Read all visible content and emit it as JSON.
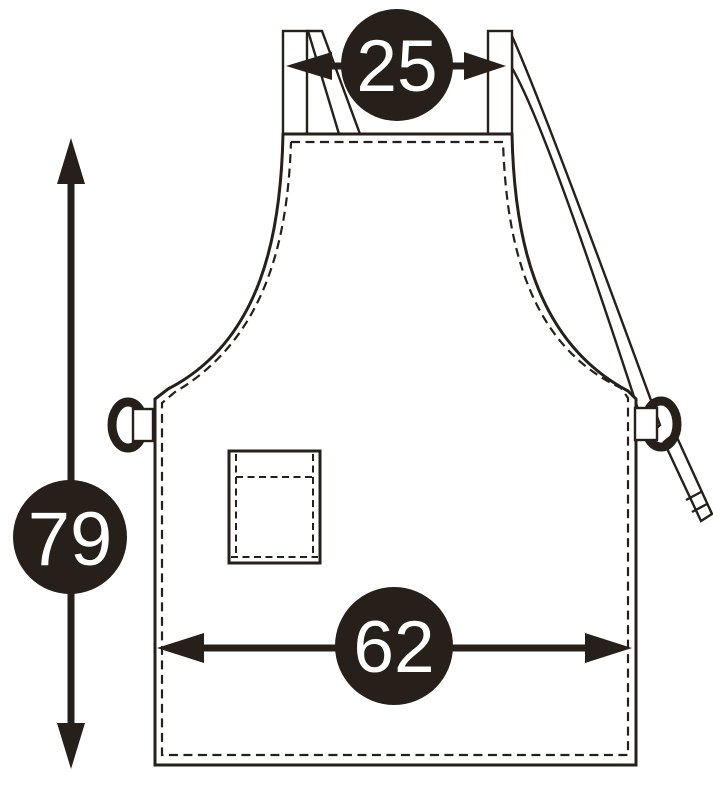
{
  "diagram": {
    "subject": "apron-size-measurement-diagram",
    "measurements": {
      "top_width": "25",
      "height": "79",
      "bottom_width": "62"
    },
    "colors": {
      "ink": "#271f1a",
      "badge_fill": "#271f1a",
      "badge_text": "#ffffff",
      "background": "#ffffff"
    }
  }
}
